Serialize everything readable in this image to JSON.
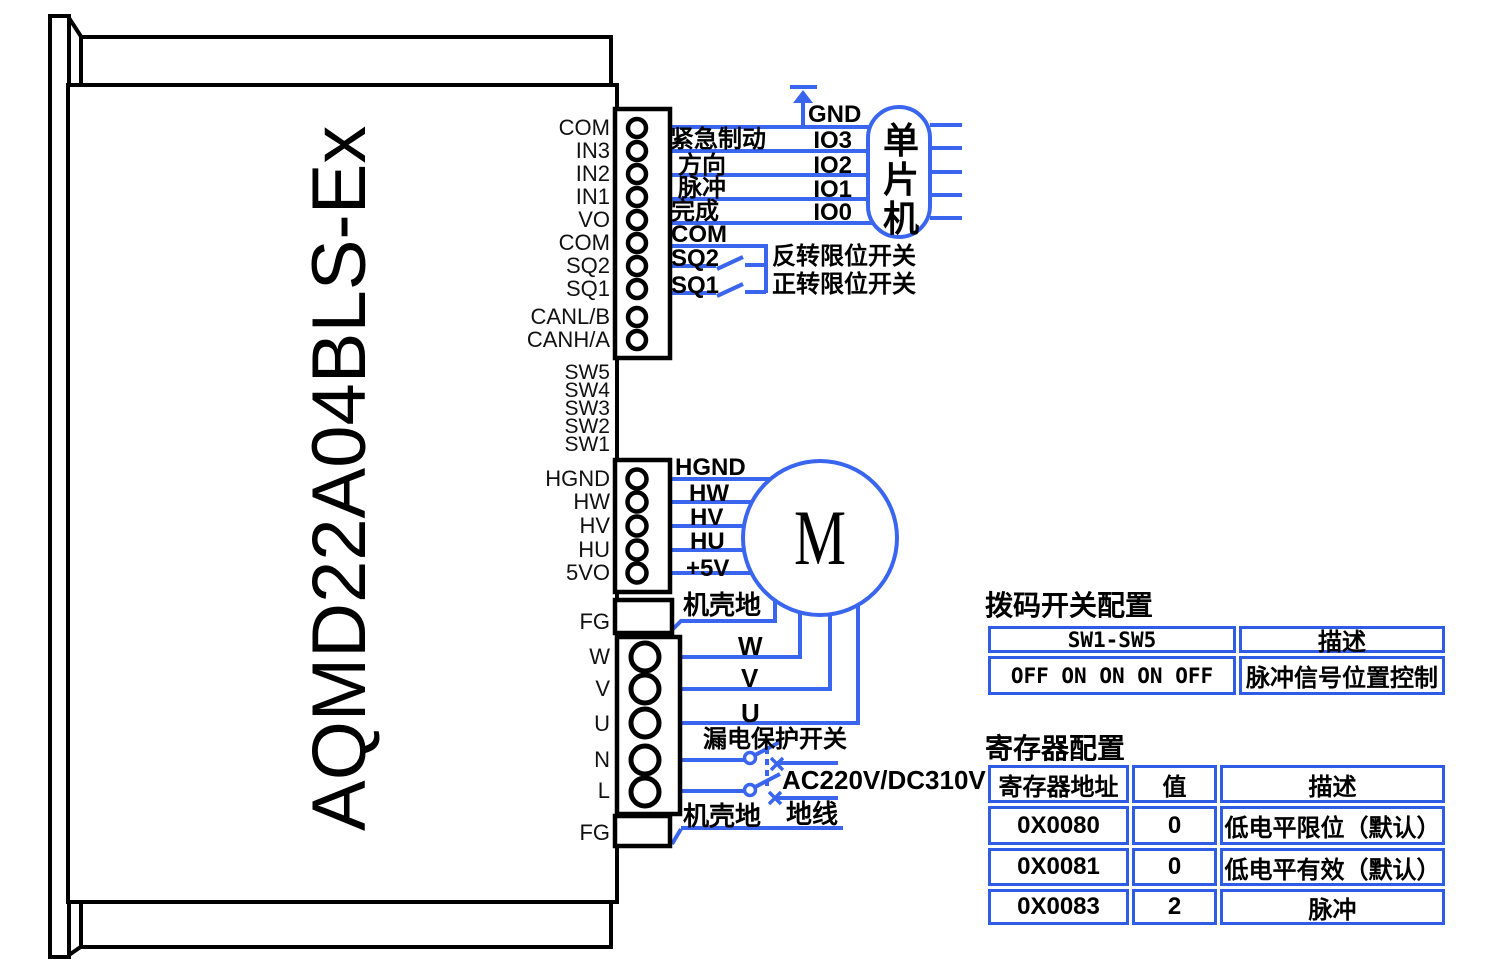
{
  "model": "AQMD22A04BLS-Ex",
  "connectors": {
    "signal_pins": [
      "COM",
      "IN3",
      "IN2",
      "IN1",
      "VO",
      "COM",
      "SQ2",
      "SQ1",
      "CANL/B",
      "CANH/A"
    ],
    "dip_pins": [
      "SW5",
      "SW4",
      "SW3",
      "SW2",
      "SW1"
    ],
    "hall_pins": [
      "HGND",
      "HW",
      "HV",
      "HU",
      "5VO"
    ],
    "power_pins": [
      "FG",
      "W",
      "V",
      "U",
      "N",
      "L",
      "FG"
    ]
  },
  "mcu": {
    "name_vertical": "单\n片\n机",
    "gnd_label": "GND",
    "rows": [
      {
        "signal": "紧急制动",
        "io": "IO3"
      },
      {
        "signal": "方向",
        "io": "IO2"
      },
      {
        "signal": "脉冲",
        "io": "IO1"
      },
      {
        "signal": "完成",
        "io": "IO0"
      }
    ]
  },
  "limit_switches": {
    "com": "COM",
    "sq2": "SQ2",
    "sq2_name": "反转限位开关",
    "sq1": "SQ1",
    "sq1_name": "正转限位开关"
  },
  "motor": {
    "symbol": "M",
    "hall_wires": [
      "HGND",
      "HW",
      "HV",
      "HU",
      "+5V"
    ],
    "case_ground": "机壳地",
    "phase_wires": [
      "W",
      "V",
      "U"
    ]
  },
  "power": {
    "breaker": "漏电保护开关",
    "supply": "AC220V/DC310V",
    "case_ground": "机壳地",
    "earth": "地线"
  },
  "dip_table": {
    "title": "拨码开关配置",
    "headers": [
      "SW1-SW5",
      "描述"
    ],
    "rows": [
      [
        "OFF ON ON ON OFF",
        "脉冲信号位置控制"
      ]
    ]
  },
  "reg_table": {
    "title": "寄存器配置",
    "headers": [
      "寄存器地址",
      "值",
      "描述"
    ],
    "rows": [
      [
        "0X0080",
        "0",
        "低电平限位（默认）"
      ],
      [
        "0X0081",
        "0",
        "低电平有效（默认）"
      ],
      [
        "0X0083",
        "2",
        "脉冲"
      ]
    ]
  },
  "colors": {
    "wire": "#3a66ef",
    "table_border": "#2e5ce4",
    "ink": "#000000"
  }
}
